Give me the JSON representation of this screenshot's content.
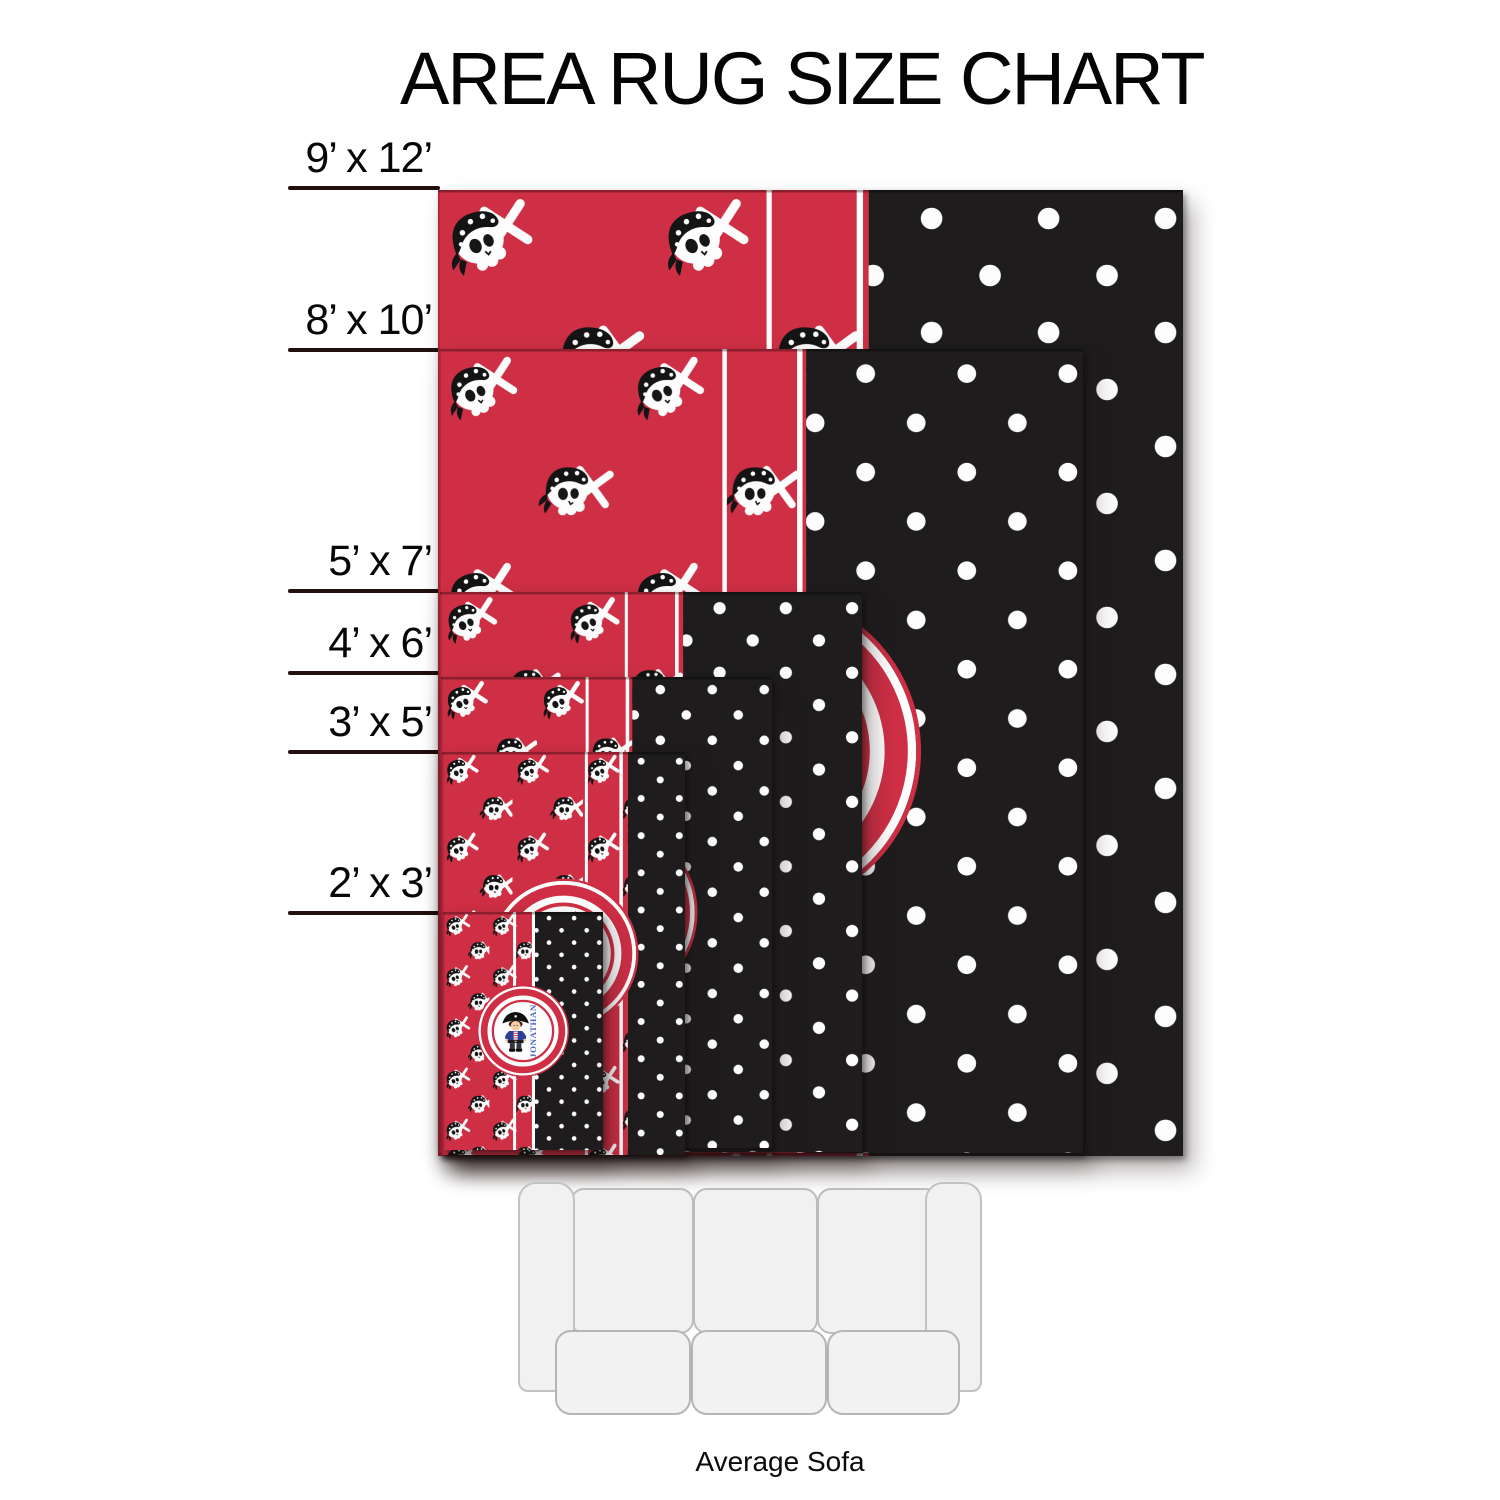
{
  "title": "AREA RUG SIZE CHART",
  "monogram": "JONATHAN",
  "sofa": {
    "label": "Average Sofa"
  },
  "colors": {
    "background": "#ffffff",
    "rug_red": "#ce2f45",
    "rug_black": "#1e1c1d",
    "pattern_white": "#fdfdfd",
    "label_line": "#220f0f",
    "label_text": "#070707",
    "monogram_blue": "#4a62c4"
  },
  "rugs": [
    {
      "id": "9x12",
      "label": "9’ x 12’",
      "width_ft": 9,
      "height_ft": 12,
      "left": 438,
      "top": 190,
      "width": 745,
      "height": 966,
      "line_y": 188,
      "s1": 0.441,
      "s2": 0.562,
      "black": 0.578,
      "badge_d": 0.5,
      "skull_w": 92
    },
    {
      "id": "8x10",
      "label": "8’ x 10’",
      "width_ft": 8,
      "height_ft": 10,
      "left": 439,
      "top": 349,
      "width": 644,
      "height": 804,
      "line_y": 350,
      "s1": 0.44,
      "s2": 0.556,
      "black": 0.57,
      "badge_d": 0.497,
      "skull_w": 76
    },
    {
      "id": "5x7",
      "label": "5’ x 7’",
      "width_ft": 5,
      "height_ft": 7,
      "left": 440,
      "top": 592,
      "width": 422,
      "height": 560,
      "line_y": 591,
      "s1": 0.438,
      "s2": 0.557,
      "black": 0.576,
      "badge_d": 0.5,
      "skull_w": 56
    },
    {
      "id": "4x6",
      "label": "4’ x 6’",
      "width_ft": 4,
      "height_ft": 6,
      "left": 441,
      "top": 677,
      "width": 331,
      "height": 471,
      "line_y": 673,
      "s1": 0.437,
      "s2": 0.558,
      "black": 0.578,
      "badge_d": 0.55,
      "skull_w": 46
    },
    {
      "id": "3x5",
      "label": "3’ x 5’",
      "width_ft": 3,
      "height_ft": 5,
      "left": 442,
      "top": 752,
      "width": 243,
      "height": 403,
      "line_y": 752,
      "s1": 0.588,
      "s2": 0.73,
      "black": 0.765,
      "badge_d": 0.617,
      "skull_w": 36
    },
    {
      "id": "2x3",
      "label": "2’ x 3’",
      "width_ft": 2,
      "height_ft": 3,
      "left": 443,
      "top": 912,
      "width": 160,
      "height": 238,
      "line_y": 913,
      "s1": 0.438,
      "s2": 0.556,
      "black": 0.575,
      "badge_d": 0.575,
      "skull_w": 27
    }
  ]
}
